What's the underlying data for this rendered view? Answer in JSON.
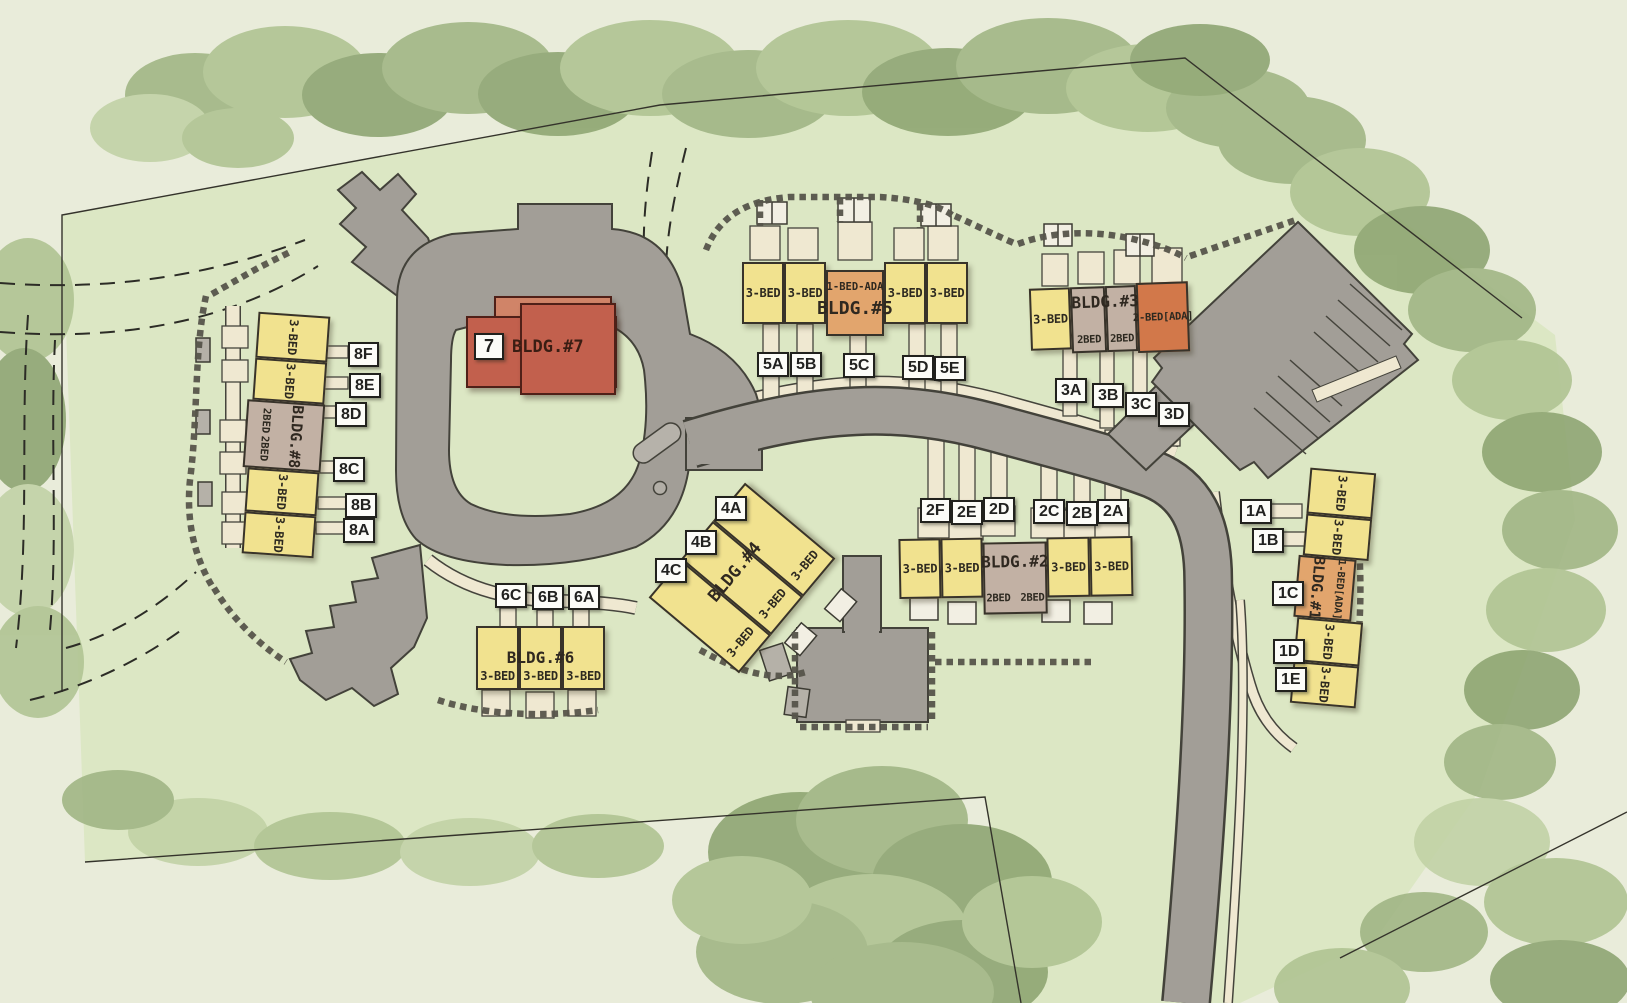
{
  "plan_type": "residential-site-plan",
  "palette": {
    "lawn": "#dce7c4",
    "outer": "#e9ecda",
    "tree": "#9db380",
    "road": "#a29e97",
    "walk": "#efe8d1",
    "unit_yellow": "#f1e28f",
    "unit_mauve": "#c2b1a4",
    "unit_orange": "#e2a56d",
    "unit_orange_dark": "#d2784a",
    "building_red": "#c2604d"
  },
  "buildings": {
    "b1": {
      "label": "BLDG.#1",
      "units": [
        "3-BED",
        "3-BED",
        "1-BED[ADA]",
        "3-BED",
        "3-BED"
      ],
      "chips": [
        "1A",
        "1B",
        "1C",
        "1D",
        "1E"
      ]
    },
    "b2": {
      "label": "BLDG.#2",
      "units": [
        "3-BED",
        "3-BED",
        "2BED",
        "2BED",
        "3-BED",
        "3-BED"
      ],
      "chips": [
        "2F",
        "2E",
        "2D",
        "2C",
        "2B",
        "2A"
      ]
    },
    "b3": {
      "label": "BLDG.#3",
      "units": [
        "3-BED",
        "2BED",
        "2BED",
        "2-BED[ADA]"
      ],
      "chips": [
        "3A",
        "3B",
        "3C",
        "3D"
      ]
    },
    "b4": {
      "label": "BLDG.#4",
      "units": [
        "3-BED",
        "3-BED",
        "3-BED"
      ],
      "chips": [
        "4A",
        "4B",
        "4C"
      ]
    },
    "b5": {
      "label": "BLDG.#5",
      "units": [
        "3-BED",
        "3-BED",
        "1-BED-ADA",
        "3-BED",
        "3-BED"
      ],
      "chips": [
        "5A",
        "5B",
        "5C",
        "5D",
        "5E"
      ]
    },
    "b6": {
      "label": "BLDG.#6",
      "units": [
        "3-BED",
        "3-BED",
        "3-BED"
      ],
      "chips": [
        "6C",
        "6B",
        "6A"
      ]
    },
    "b7": {
      "label": "BLDG.#7",
      "badge": "7"
    },
    "b8": {
      "label": "BLDG.#8",
      "units": [
        "3-BED",
        "3-BED",
        "2BED",
        "2BED",
        "3-BED",
        "3-BED"
      ],
      "chips": [
        "8F",
        "8E",
        "8D",
        "8C",
        "8B",
        "8A"
      ]
    }
  }
}
